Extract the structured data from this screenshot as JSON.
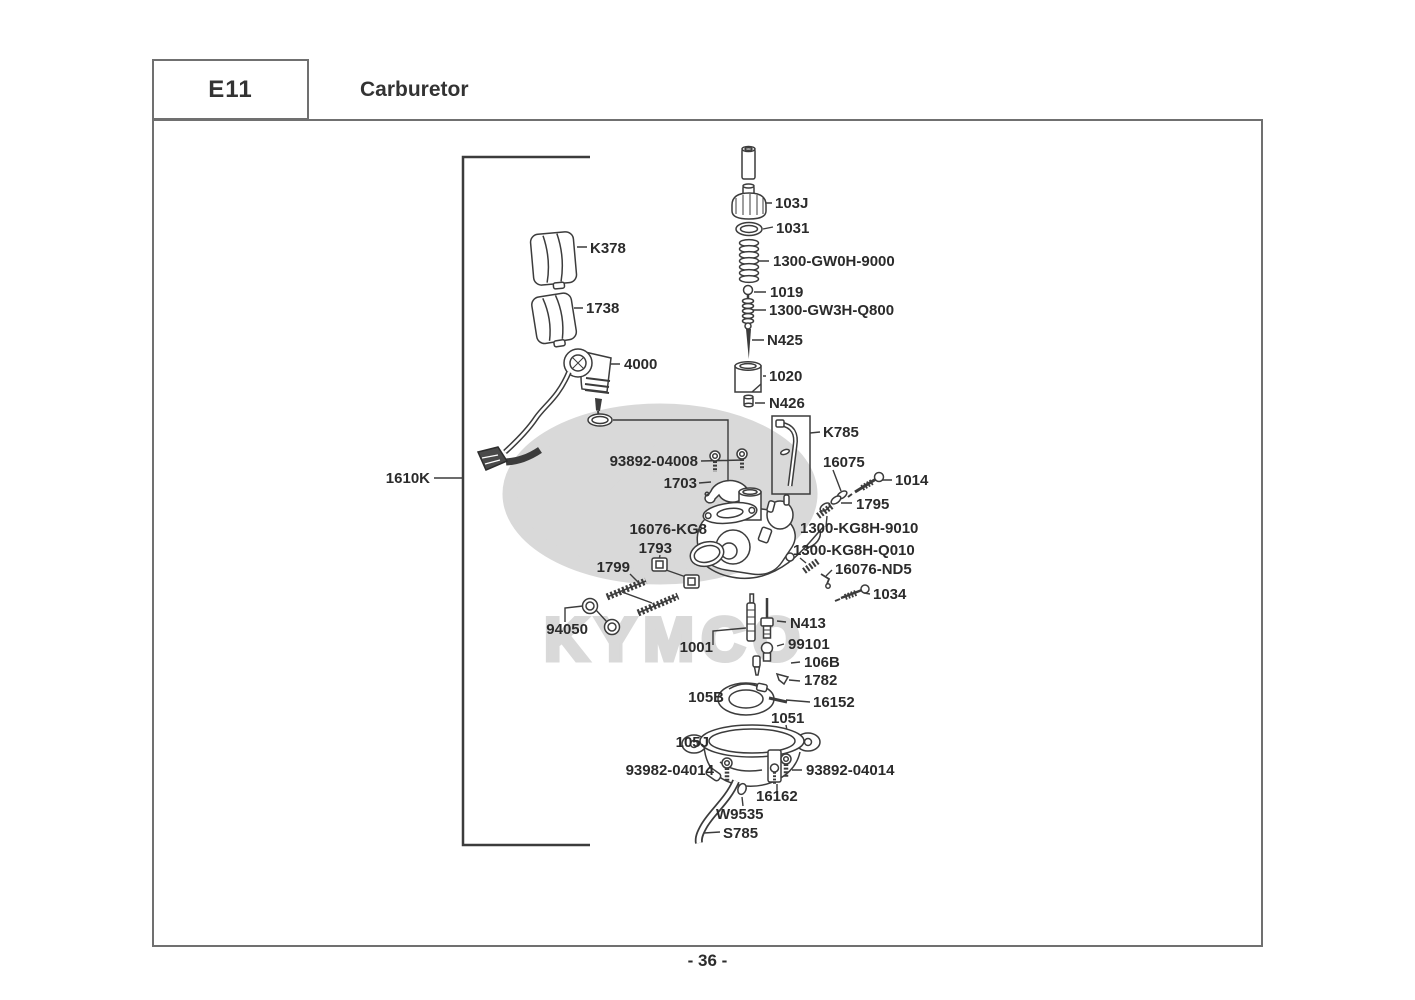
{
  "header": {
    "code": "E11",
    "title": "Carburetor"
  },
  "footer": {
    "page_label": "- 36 -"
  },
  "watermark": {
    "letter": "K",
    "brand": "KYMCO"
  },
  "colors": {
    "line": "#3c3c3c",
    "label": "#2b2b2b",
    "frame": "#707070",
    "watermark": "#d9d9d9"
  },
  "diagram": {
    "description": "Carburetor exploded parts diagram",
    "labels": [
      {
        "id": "103J",
        "text": "103J"
      },
      {
        "id": "1031",
        "text": "1031"
      },
      {
        "id": "1300-GW0H-9000",
        "text": "1300-GW0H-9000"
      },
      {
        "id": "1019",
        "text": "1019"
      },
      {
        "id": "1300-GW3H-Q800",
        "text": "1300-GW3H-Q800"
      },
      {
        "id": "N425",
        "text": "N425"
      },
      {
        "id": "1020",
        "text": "1020"
      },
      {
        "id": "N426",
        "text": "N426"
      },
      {
        "id": "K785",
        "text": "K785"
      },
      {
        "id": "93892-04008",
        "text": "93892-04008"
      },
      {
        "id": "16075",
        "text": "16075"
      },
      {
        "id": "1014",
        "text": "1014"
      },
      {
        "id": "1703",
        "text": "1703"
      },
      {
        "id": "1795",
        "text": "1795"
      },
      {
        "id": "16076-KG8",
        "text": "16076-KG8"
      },
      {
        "id": "1300-KG8H-9010",
        "text": "1300-KG8H-9010"
      },
      {
        "id": "1793",
        "text": "1793"
      },
      {
        "id": "1300-KG8H-Q010",
        "text": "1300-KG8H-Q010"
      },
      {
        "id": "1799",
        "text": "1799"
      },
      {
        "id": "16076-ND5",
        "text": "16076-ND5"
      },
      {
        "id": "1034",
        "text": "1034"
      },
      {
        "id": "94050",
        "text": "94050"
      },
      {
        "id": "N413",
        "text": "N413"
      },
      {
        "id": "1001",
        "text": "1001"
      },
      {
        "id": "99101",
        "text": "99101"
      },
      {
        "id": "106B",
        "text": "106B"
      },
      {
        "id": "1782",
        "text": "1782"
      },
      {
        "id": "105B",
        "text": "105B"
      },
      {
        "id": "16152",
        "text": "16152"
      },
      {
        "id": "1051",
        "text": "1051"
      },
      {
        "id": "105J",
        "text": "105J"
      },
      {
        "id": "93982-04014",
        "text": "93982-04014"
      },
      {
        "id": "93892-04014",
        "text": "93892-04014"
      },
      {
        "id": "16162",
        "text": "16162"
      },
      {
        "id": "W9535",
        "text": "W9535"
      },
      {
        "id": "S785",
        "text": "S785"
      },
      {
        "id": "1610K",
        "text": "1610K"
      },
      {
        "id": "4000",
        "text": "4000"
      },
      {
        "id": "K378",
        "text": "K378"
      },
      {
        "id": "1738",
        "text": "1738"
      }
    ]
  }
}
